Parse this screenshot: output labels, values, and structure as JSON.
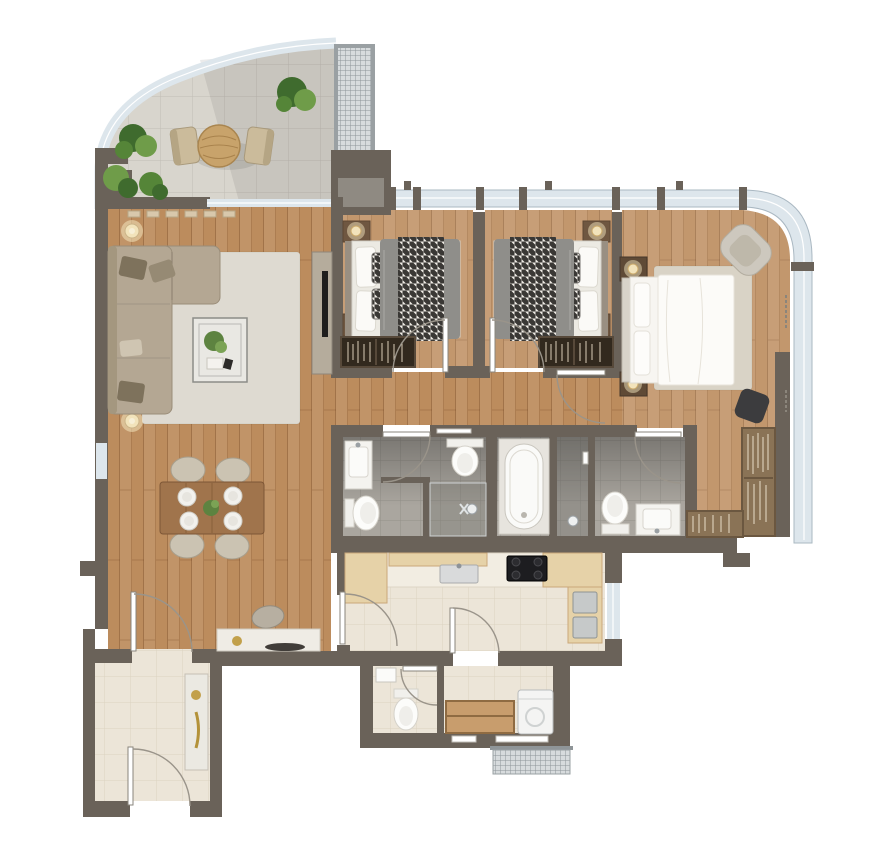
{
  "meta": {
    "title": "Apartment floor plan – rendered top-down view",
    "type": "3d-rendered residential floor plan, no text labels visible"
  },
  "colors": {
    "wall": "#6a6259",
    "wallLight": "#8f8a82",
    "wood": "#bc8c5d",
    "woodBed": "#c59a6a",
    "terrace": "#d8d5cd",
    "tileGray": "#aaa69f",
    "tileCream": "#ece5d8",
    "glass": "#dde6ec",
    "glassFrame": "#aab8c2",
    "grille": "#d7dbdd",
    "rug": "#dedad1",
    "rugMaster": "#d9d3c6",
    "sofa": "#b4a793",
    "sofaPillowDark": "#7e725c",
    "fixture": "#fafaf8",
    "counter": "#f2ede2",
    "cabinetWood": "#e6d2a8",
    "cooktop": "#1d1d20",
    "appliance": "#c6c9c9",
    "blanket": "#8f8e8a",
    "bedWhite": "#f7f5f1",
    "nightstand": "#6f5741",
    "lamp": "#f2e3bb",
    "wardrobeDark": "#32291e",
    "closetWood": "#8a7356",
    "tableWood": "#a0744c",
    "chairBeige": "#cbc3b2",
    "plantDark": "#3f6b2e",
    "plantLight": "#6f9c49",
    "gold": "#c2a04a",
    "doorArc": "#9a948a",
    "doorLeaf": "#ffffff",
    "tubSurround": "#e7e4de"
  },
  "plan": {
    "rooms": [
      {
        "id": "terrace",
        "label": "Terrace / balcony",
        "floor": "light stone tiles",
        "furniture": [
          "round bistro table",
          "2 outdoor chairs",
          "4 green planters",
          "curved glass railing",
          "ventilation grille panel"
        ]
      },
      {
        "id": "living-room",
        "label": "Living room",
        "floor": "wood planks",
        "furniture": [
          "L-shaped sectional sofa",
          "accent pillows",
          "area rug",
          "glass coffee table with plant",
          "2 floor lamps",
          "TV console",
          "wall TV",
          "radiator under window"
        ]
      },
      {
        "id": "dining-area",
        "label": "Dining area",
        "floor": "wood planks",
        "furniture": [
          "rectangular dining table",
          "4 chairs",
          "4 place settings",
          "plant centerpiece"
        ]
      },
      {
        "id": "study-nook",
        "label": "Desk nook",
        "floor": "wood planks",
        "furniture": [
          "console desk",
          "chair",
          "decor tray"
        ]
      },
      {
        "id": "entrance-hall",
        "label": "Entrance hall",
        "floor": "cream tiles",
        "furniture": [
          "tall console cabinet with gold decor"
        ]
      },
      {
        "id": "bedroom-1",
        "label": "Bedroom 1",
        "floor": "wood planks",
        "furniture": [
          "double bed with houndstooth throw",
          "2 nightstands with lamps",
          "wardrobe with clothes"
        ]
      },
      {
        "id": "bedroom-2",
        "label": "Bedroom 2 (mirrored)",
        "floor": "wood planks",
        "furniture": [
          "double bed with houndstooth throw",
          "2 nightstands with lamps",
          "wardrobe with clothes"
        ]
      },
      {
        "id": "master-bedroom",
        "label": "Master bedroom",
        "floor": "wood planks",
        "furniture": [
          "king bed with white duvet",
          "2 nightstands with lamps",
          "lounge armchair",
          "dark ottoman",
          "area rug",
          "curtains along glazing"
        ]
      },
      {
        "id": "walk-in-closet",
        "label": "Walk-in closet",
        "floor": "wood planks",
        "furniture": [
          "L-shaped open wardrobe units"
        ]
      },
      {
        "id": "bathroom-1",
        "label": "Shared bathroom",
        "floor": "gray tiles",
        "furniture": [
          "washbasin counter",
          "toilet",
          "bidet",
          "walk-in shower",
          "towel rail"
        ]
      },
      {
        "id": "master-bathroom",
        "label": "Master bathroom",
        "floor": "gray tiles",
        "furniture": [
          "bathtub",
          "shower area",
          "toilet",
          "washbasin counter"
        ]
      },
      {
        "id": "corridor",
        "label": "Bedroom corridor",
        "floor": "wood planks",
        "furniture": []
      },
      {
        "id": "kitchen",
        "label": "Kitchen",
        "floor": "cream tiles",
        "furniture": [
          "counter run",
          "wood cabinets",
          "sink",
          "4-burner cooktop",
          "built-in appliances",
          "side window"
        ]
      },
      {
        "id": "guest-wc",
        "label": "Guest WC",
        "floor": "cream tiles",
        "furniture": [
          "toilet",
          "small washbasin"
        ]
      },
      {
        "id": "utility-room",
        "label": "Utility room",
        "floor": "cream tiles",
        "furniture": [
          "wood shelving unit",
          "washing machine",
          "exterior vent grate"
        ]
      }
    ],
    "doors": [
      "entry door (hall, bottom wall)",
      "hall to dining door",
      "bedroom-1 door",
      "bedroom-2 door",
      "master bedroom door",
      "shared bathroom door",
      "master bathroom door",
      "kitchen-dining door",
      "kitchen-utility door",
      "guest WC door"
    ],
    "glazing": [
      "curved glass railing around terrace",
      "curtain-wall window band across bedrooms curving down right side",
      "living room top window",
      "dining side window",
      "kitchen side window"
    ]
  }
}
